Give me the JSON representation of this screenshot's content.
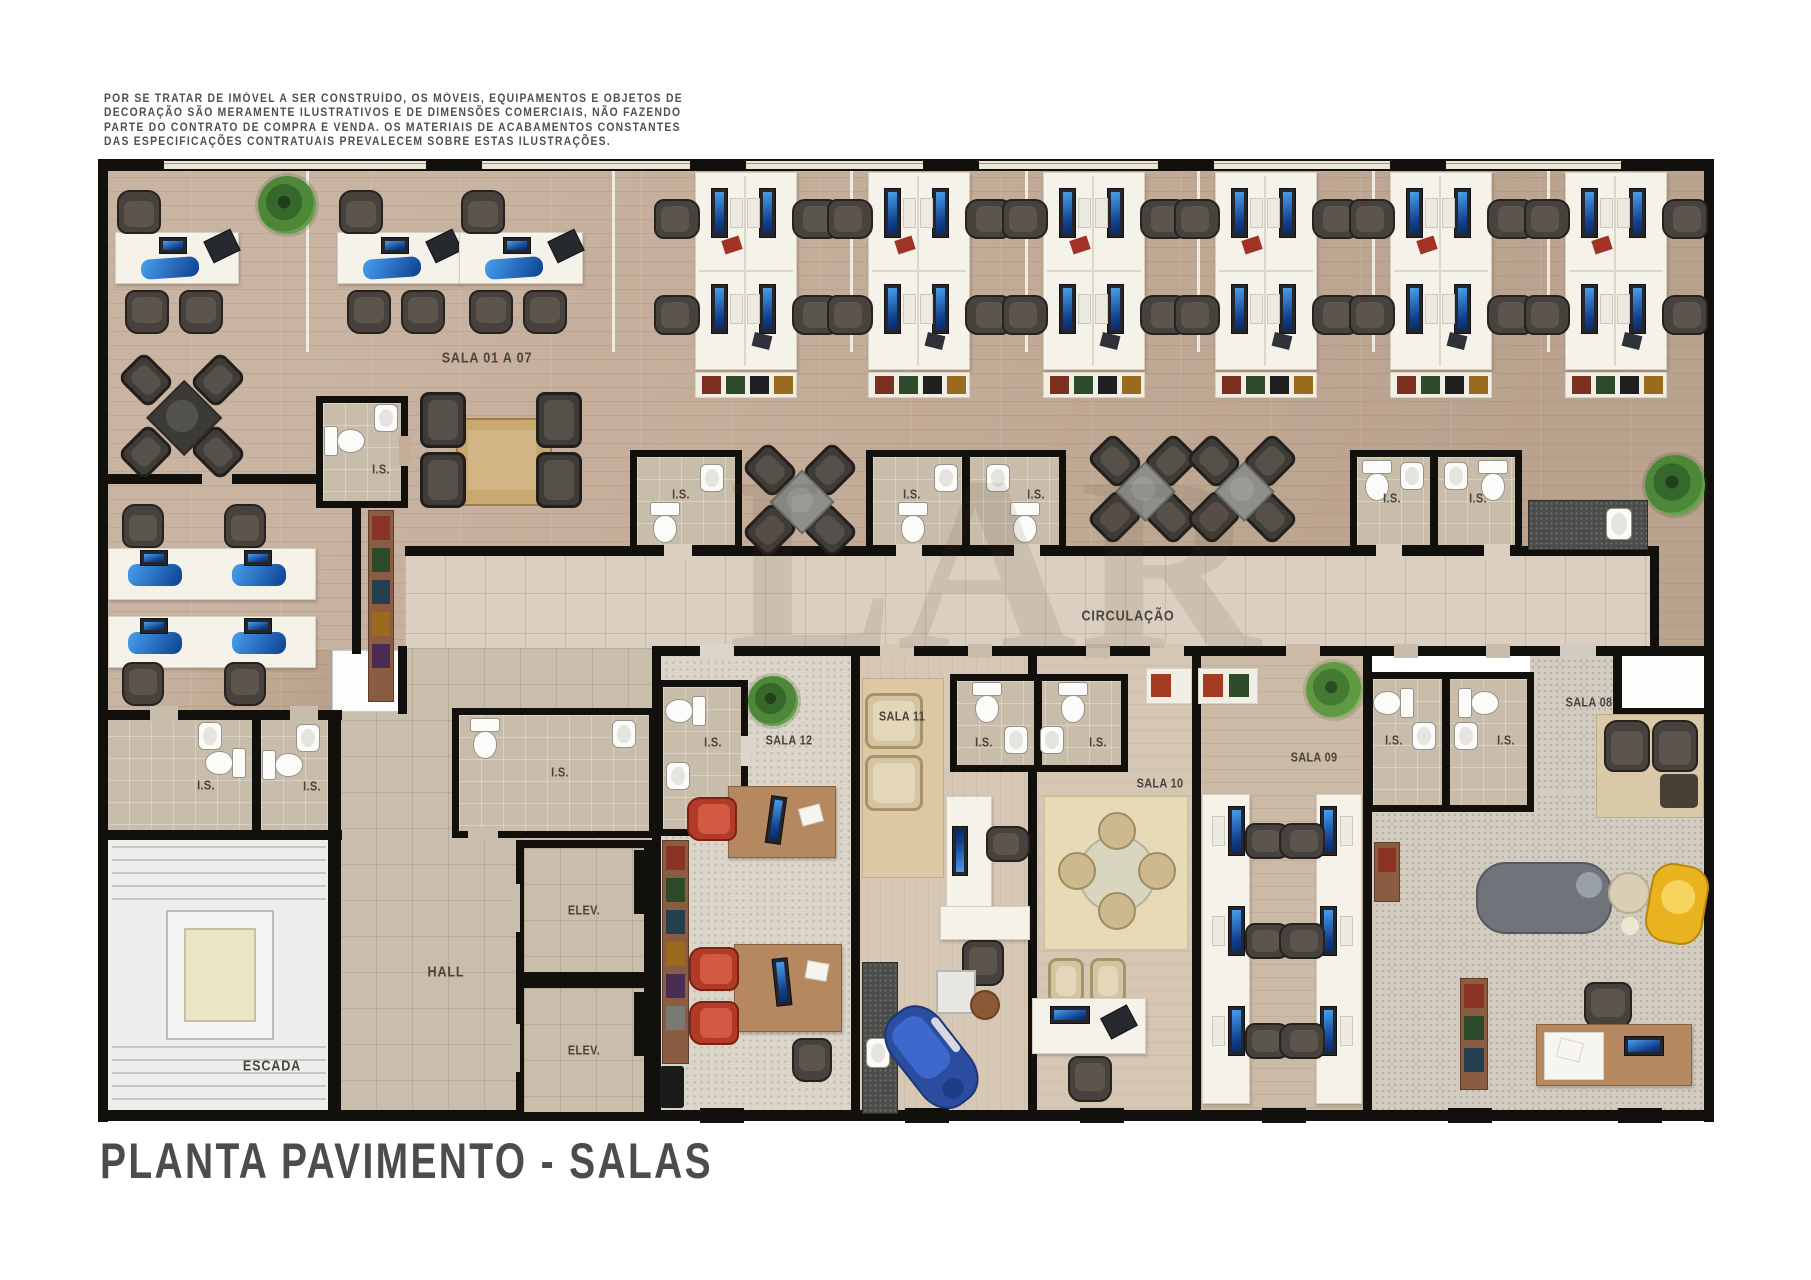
{
  "document": {
    "disclaimer_lines": [
      "POR SE TRATAR DE IMÓVEL A SER CONSTRUÍDO, OS MÓVEIS, EQUIPAMENTOS E OBJETOS DE",
      "DECORAÇÃO SÃO MERAMENTE ILUSTRATIVOS E DE DIMENSÕES COMERCIAIS, NÃO FAZENDO",
      "PARTE DO CONTRATO DE COMPRA E VENDA. OS MATERIAIS DE ACABAMENTOS CONSTANTES",
      "DAS ESPECIFICAÇÕES CONTRATUAIS PREVALECEM SOBRE ESTAS ILUSTRAÇÕES."
    ],
    "title": "PLANTA PAVIMENTO  - SALAS",
    "watermark": "LAR"
  },
  "rooms": {
    "sala_01_07": "SALA 01 A 07",
    "circulacao": "CIRCULAÇÃO",
    "is": "I.S.",
    "sala_08": "SALA 08",
    "sala_09": "SALA 09",
    "sala_10": "SALA 10",
    "sala_11": "SALA 11",
    "sala_12": "SALA 12",
    "hall": "HALL",
    "elev": "ELEV.",
    "escada": "ESCADA"
  },
  "colors": {
    "wall": "#12100d",
    "wood_floor": "#c3ac98",
    "corridor_tile": "#dacfc0",
    "bath_tile": "#c8bcab",
    "screen_blue": "#2e7fe8",
    "red_chair": "#b23a28",
    "dental_blue": "#2a4da0",
    "yellow_chair": "#e9b31f"
  }
}
